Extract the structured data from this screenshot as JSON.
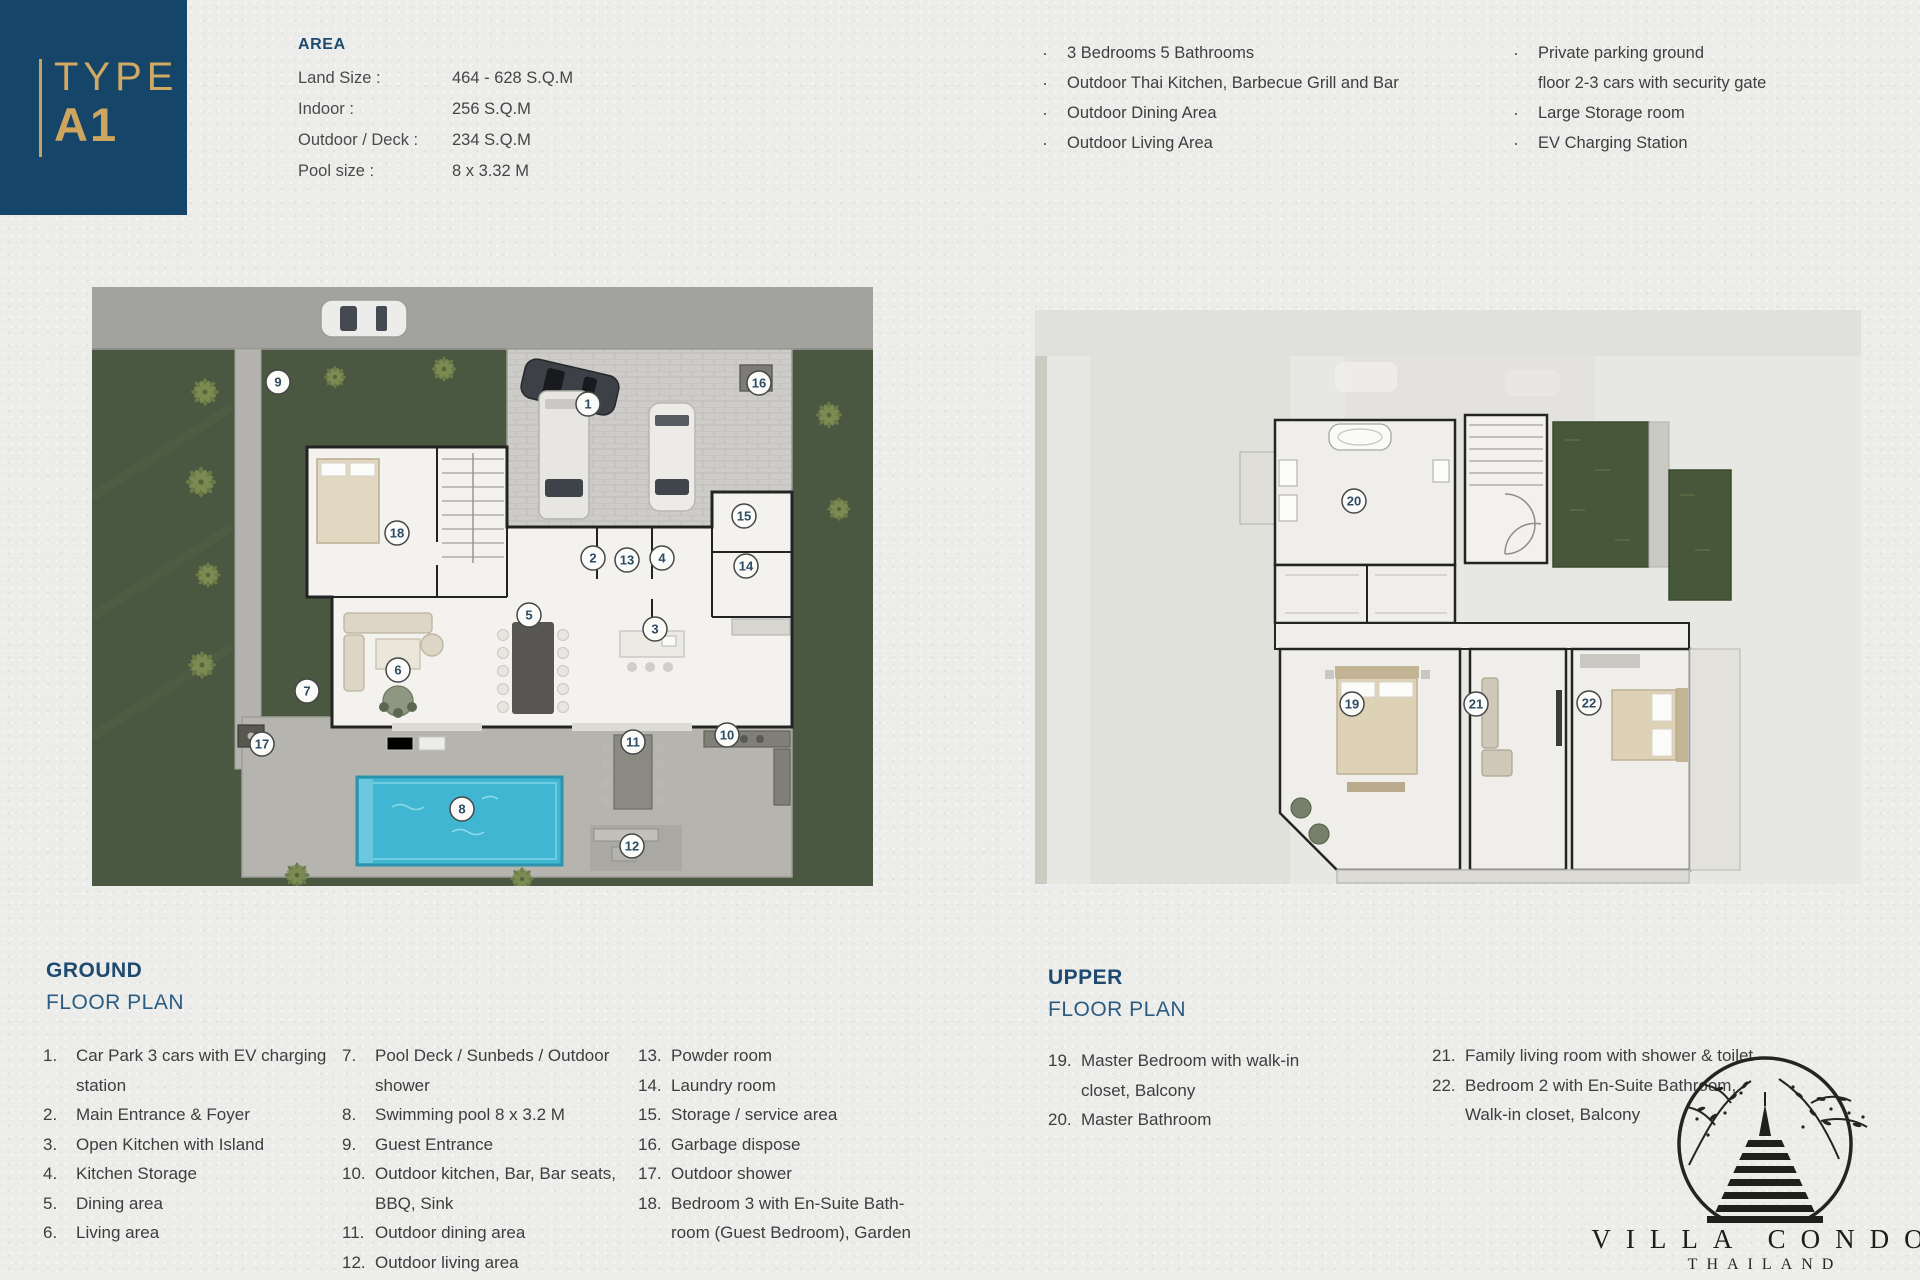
{
  "colors": {
    "navy": "#16456a",
    "gold": "#cda55f",
    "pool_blue": "#41b6d3",
    "garden_green": "#4a5741"
  },
  "type_badge": {
    "top": "TYPE",
    "bottom": "A1"
  },
  "area": {
    "title": "AREA",
    "rows": [
      {
        "label": "Land Size :",
        "value": "464 - 628  S.Q.M"
      },
      {
        "label": "Indoor :",
        "value": "256 S.Q.M"
      },
      {
        "label": "Outdoor / Deck :",
        "value": "234 S.Q.M"
      },
      {
        "label": "Pool size :",
        "value": "8 x 3.32 M"
      }
    ]
  },
  "features": {
    "col1": [
      {
        "lines": [
          "3 Bedrooms 5 Bathrooms"
        ]
      },
      {
        "lines": [
          "Outdoor Thai Kitchen, Barbecue Grill and Bar"
        ]
      },
      {
        "lines": [
          "Outdoor Dining Area"
        ]
      },
      {
        "lines": [
          "Outdoor Living Area"
        ]
      }
    ],
    "col2": [
      {
        "lines": [
          "Private parking ground",
          "floor 2-3 cars with security gate"
        ]
      },
      {
        "lines": [
          "Large Storage room"
        ]
      },
      {
        "lines": [
          "EV Charging Station"
        ]
      }
    ]
  },
  "ground": {
    "title1": "GROUND",
    "title2": "FLOOR PLAN",
    "col1": [
      {
        "num": "1.",
        "lines": [
          "Car Park 3 cars with EV charging",
          "station"
        ]
      },
      {
        "num": "2.",
        "lines": [
          "Main Entrance & Foyer"
        ]
      },
      {
        "num": "3.",
        "lines": [
          "Open Kitchen with Island"
        ]
      },
      {
        "num": "4.",
        "lines": [
          "Kitchen Storage"
        ]
      },
      {
        "num": "5.",
        "lines": [
          "Dining area"
        ]
      },
      {
        "num": "6.",
        "lines": [
          "Living area"
        ]
      }
    ],
    "col2": [
      {
        "num": "7.",
        "lines": [
          "Pool Deck / Sunbeds / Outdoor",
          "shower"
        ]
      },
      {
        "num": "8.",
        "lines": [
          "Swimming pool 8 x 3.2 M"
        ]
      },
      {
        "num": "9.",
        "lines": [
          "Guest Entrance"
        ]
      },
      {
        "num": "10.",
        "lines": [
          "Outdoor kitchen, Bar, Bar seats,",
          "BBQ, Sink"
        ]
      },
      {
        "num": "11.",
        "lines": [
          "Outdoor dining area"
        ]
      },
      {
        "num": "12.",
        "lines": [
          "Outdoor living area"
        ]
      }
    ],
    "col3": [
      {
        "num": "13.",
        "lines": [
          "Powder room"
        ]
      },
      {
        "num": "14.",
        "lines": [
          "Laundry room"
        ]
      },
      {
        "num": "15.",
        "lines": [
          "Storage / service area"
        ]
      },
      {
        "num": "16.",
        "lines": [
          "Garbage dispose"
        ]
      },
      {
        "num": "17.",
        "lines": [
          "Outdoor shower"
        ]
      },
      {
        "num": "18.",
        "lines": [
          "Bedroom 3 with En-Suite Bath-",
          "room (Guest Bedroom), Garden"
        ]
      }
    ],
    "markers": [
      {
        "n": "1",
        "x": 496,
        "y": 117
      },
      {
        "n": "2",
        "x": 501,
        "y": 271
      },
      {
        "n": "3",
        "x": 563,
        "y": 342
      },
      {
        "n": "4",
        "x": 570,
        "y": 271
      },
      {
        "n": "5",
        "x": 437,
        "y": 328
      },
      {
        "n": "6",
        "x": 306,
        "y": 383
      },
      {
        "n": "7",
        "x": 215,
        "y": 404
      },
      {
        "n": "8",
        "x": 370,
        "y": 522
      },
      {
        "n": "9",
        "x": 186,
        "y": 95
      },
      {
        "n": "10",
        "x": 635,
        "y": 448
      },
      {
        "n": "11",
        "x": 541,
        "y": 455
      },
      {
        "n": "12",
        "x": 540,
        "y": 559
      },
      {
        "n": "13",
        "x": 535,
        "y": 273
      },
      {
        "n": "14",
        "x": 654,
        "y": 279
      },
      {
        "n": "15",
        "x": 652,
        "y": 229
      },
      {
        "n": "16",
        "x": 667,
        "y": 96
      },
      {
        "n": "17",
        "x": 170,
        "y": 457
      },
      {
        "n": "18",
        "x": 305,
        "y": 246
      }
    ]
  },
  "upper": {
    "title1": "UPPER",
    "title2": "FLOOR PLAN",
    "col1": [
      {
        "num": "19.",
        "lines": [
          "Master Bedroom with walk-in",
          "closet, Balcony"
        ]
      },
      {
        "num": "20.",
        "lines": [
          "Master Bathroom"
        ]
      }
    ],
    "col2": [
      {
        "num": "21.",
        "lines": [
          "Family living room with shower & toilet"
        ]
      },
      {
        "num": "22.",
        "lines": [
          "Bedroom 2 with En-Suite Bathroom,",
          "Walk-in closet, Balcony"
        ]
      }
    ],
    "markers": [
      {
        "n": "19",
        "x": 317,
        "y": 394
      },
      {
        "n": "20",
        "x": 319,
        "y": 191
      },
      {
        "n": "21",
        "x": 441,
        "y": 394
      },
      {
        "n": "22",
        "x": 554,
        "y": 393
      }
    ]
  },
  "logo": {
    "title": "VILLA CONDO",
    "subtitle": "THAILAND"
  }
}
